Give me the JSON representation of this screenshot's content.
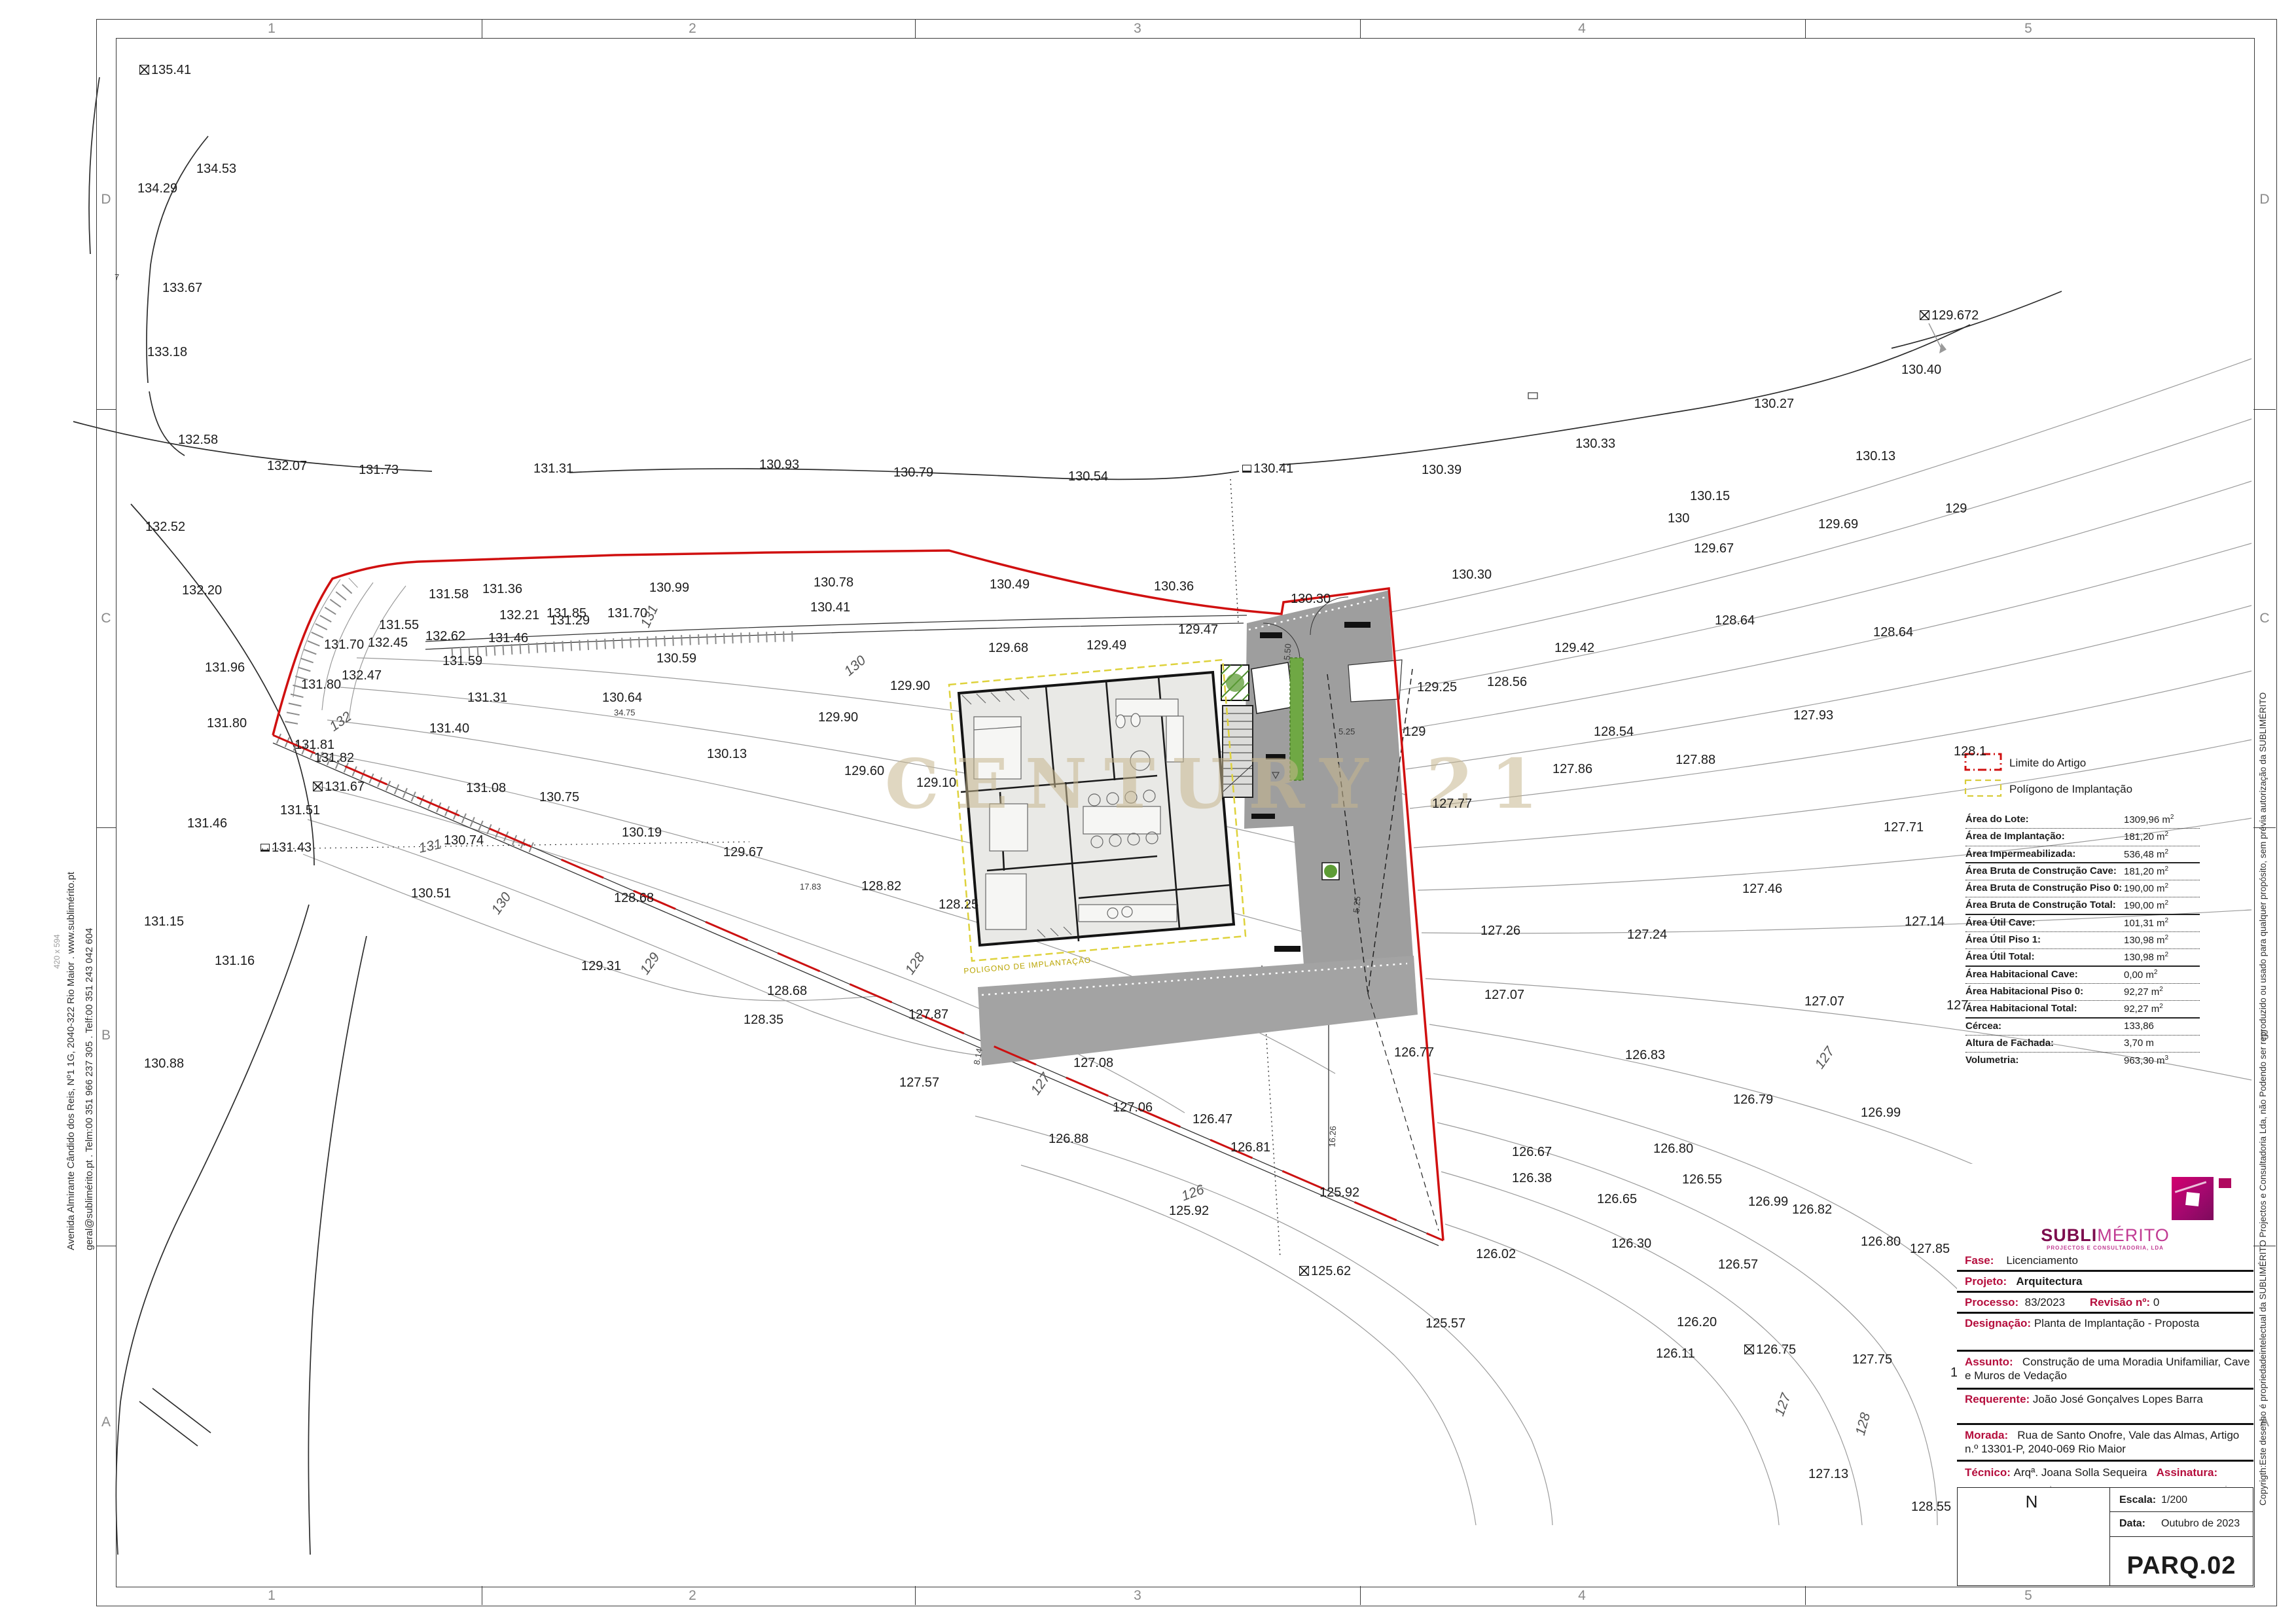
{
  "sheet": {
    "code": "PARQ.02",
    "escala_label": "Escala:",
    "escala": "1/200",
    "data_label": "Data:",
    "data": "Outubro de 2023",
    "north_label": "N",
    "paper_size": "420 x 594"
  },
  "margins": {
    "numbers": [
      "1",
      "2",
      "3",
      "4",
      "5"
    ],
    "letters": [
      "D",
      "C",
      "B",
      "A"
    ]
  },
  "side_texts": {
    "address_line1": "Avenida Almirante Cândido dos Reis, Nº1 1G, 2040-322 Rio Maior . www.sublimérito.pt",
    "address_line2": "geral@sublimérito.pt . Telm:00 351 966 237 305 . Telf:00 351 243 042 604",
    "copyright": "Copyrigth:Este desenho é propriedadeintelectual da SUBLIMÉRITO Projectos e Consultadoria Lda, não Podendo ser reproduzido ou usado para qualquer propósito, sem prévia autorização da SUBLIMÉRITO"
  },
  "watermark": "CENTURY 21",
  "legend": {
    "limite_label": "Limite do Artigo",
    "poligono_label": "Polígono de Implantação"
  },
  "logo": {
    "name_bold": "SUBLI",
    "name_light": "MÉRITO",
    "tagline": "PROJECTOS E CONSULTADORIA, LDA"
  },
  "areas_table": {
    "rows": [
      {
        "l": "Área do Lote:",
        "v": "1309,96 m",
        "s": "2",
        "sep": "dot"
      },
      {
        "l": "Área de Implantação:",
        "v": "181,20 m",
        "s": "2",
        "sep": "dot"
      },
      {
        "l": "Área Impermeabilizada:",
        "v": "536,48 m",
        "s": "2",
        "sep": "solid"
      },
      {
        "l": "Área Bruta de Construção Cave:",
        "v": "181,20 m",
        "s": "2",
        "sep": "dot"
      },
      {
        "l": "Área Bruta de Construção Piso 0:",
        "v": "190,00 m",
        "s": "2",
        "sep": "dot"
      },
      {
        "l": "Área Bruta de Construção Total:",
        "v": "190,00 m",
        "s": "2",
        "sep": "solid"
      },
      {
        "l": "Área Útil Cave:",
        "v": "101,31 m",
        "s": "2",
        "sep": "dot"
      },
      {
        "l": "Área Útil Piso 1:",
        "v": "130,98 m",
        "s": "2",
        "sep": "dot"
      },
      {
        "l": "Área Útil Total:",
        "v": "130,98 m",
        "s": "2",
        "sep": "solid"
      },
      {
        "l": "Área Habitacional Cave:",
        "v": "0,00 m",
        "s": "2",
        "sep": "dot"
      },
      {
        "l": "Área Habitacional Piso 0:",
        "v": "92,27 m",
        "s": "2",
        "sep": "dot"
      },
      {
        "l": "Área Habitacional Total: ",
        "v": "92,27 m",
        "s": "2",
        "sep": "solid"
      },
      {
        "l": "Cércea:",
        "v": "133,86",
        "s": "",
        "sep": "dot"
      },
      {
        "l": "Altura de Fachada:",
        "v": "3,70 m",
        "s": "",
        "sep": "dot"
      },
      {
        "l": "Volumetria:",
        "v": "963,30 m",
        "s": "3",
        "sep": "none"
      }
    ]
  },
  "title_block": {
    "fase_label": "Fase:",
    "fase": "Licenciamento",
    "projeto_label": "Projeto:",
    "projeto": "Arquitectura",
    "processo_label": "Processo:",
    "processo": "83/2023",
    "revisao_label": "Revisão nº:",
    "revisao": "0",
    "designacao_label": "Designação:",
    "designacao": "Planta de Implantação - Proposta",
    "assunto_label": "Assunto:",
    "assunto": "Construção de uma Moradia Unifamiliar, Cave e Muros de Vedação",
    "requerente_label": "Requerente:",
    "requerente": "João José Gonçalves Lopes Barra",
    "morada_label": "Morada:",
    "morada": "Rua de Santo Onofre, Vale das Almas, Artigo n.º 13301-P, 2040-069 Rio Maior",
    "tecnico_label": "Técnico:",
    "tecnico": "Arqª. Joana Solla Sequeira",
    "assinatura_label": "Assinatura:"
  },
  "plan": {
    "polygon_label": "POLIGONO DE IMPLANTAÇÃO",
    "labels": [
      [
        "135.41",
        213,
        107,
        "",
        0,
        "sq"
      ],
      [
        "134.53",
        300,
        258
      ],
      [
        "134.29",
        210,
        288
      ],
      [
        "133.67",
        248,
        440
      ],
      [
        "7",
        175,
        427,
        "dim"
      ],
      [
        "133.18",
        225,
        538
      ],
      [
        "132.58",
        272,
        672
      ],
      [
        "132.07",
        408,
        712
      ],
      [
        "131.73",
        548,
        718
      ],
      [
        "131.31",
        815,
        716
      ],
      [
        "130.93",
        1160,
        710
      ],
      [
        "130.79",
        1365,
        722
      ],
      [
        "130.54",
        1632,
        728
      ],
      [
        "130.41",
        1898,
        716,
        "",
        0,
        "flag"
      ],
      [
        "130.39",
        2172,
        718
      ],
      [
        "130.33",
        2407,
        678
      ],
      [
        "130.27",
        2680,
        617
      ],
      [
        "130.40",
        2905,
        565
      ],
      [
        "129.672",
        2933,
        482,
        "",
        0,
        "sq"
      ],
      [
        "130.13",
        2835,
        697
      ],
      [
        "129",
        2972,
        777
      ],
      [
        "130.30",
        2218,
        878
      ],
      [
        "130.30",
        1972,
        915
      ],
      [
        "129.69",
        2778,
        801
      ],
      [
        "129.67",
        2588,
        838
      ],
      [
        "130.15",
        2582,
        758
      ],
      [
        "130",
        2548,
        792
      ],
      [
        "129.42",
        2375,
        990
      ],
      [
        "129",
        2145,
        1118
      ],
      [
        "129.25",
        2165,
        1050
      ],
      [
        "128.64",
        2620,
        948
      ],
      [
        "128.64",
        2862,
        966
      ],
      [
        "128.54",
        2435,
        1118
      ],
      [
        "128.56",
        2272,
        1042
      ],
      [
        "129.68",
        1510,
        990
      ],
      [
        "129.49",
        1660,
        986
      ],
      [
        "129.47",
        1800,
        962
      ],
      [
        "131.55",
        579,
        955
      ],
      [
        "131.58",
        655,
        908
      ],
      [
        "131.36",
        737,
        900
      ],
      [
        "132.21",
        763,
        940
      ],
      [
        "131.85",
        835,
        937
      ],
      [
        "131.70",
        928,
        937
      ],
      [
        "131",
        985,
        957,
        "rot",
        -65
      ],
      [
        "132.62",
        650,
        972
      ],
      [
        "130.99",
        992,
        898
      ],
      [
        "130.78",
        1243,
        890
      ],
      [
        "130.49",
        1512,
        893
      ],
      [
        "130.36",
        1763,
        896
      ],
      [
        "130.41",
        1238,
        928
      ],
      [
        "131.29",
        840,
        948
      ],
      [
        "131.46",
        746,
        975
      ],
      [
        "131.59",
        676,
        1010
      ],
      [
        "131.31",
        714,
        1066
      ],
      [
        "131.40",
        656,
        1113
      ],
      [
        "131.70",
        495,
        985
      ],
      [
        "132.45",
        562,
        982
      ],
      [
        "132.47",
        522,
        1032
      ],
      [
        "131.80",
        460,
        1046
      ],
      [
        "131.96",
        313,
        1020
      ],
      [
        "132.20",
        278,
        902
      ],
      [
        "132.52",
        222,
        805
      ],
      [
        "131.80",
        316,
        1105
      ],
      [
        "132",
        506,
        1112,
        "rot",
        -35
      ],
      [
        "131.81",
        450,
        1138
      ],
      [
        "131.82",
        480,
        1158
      ],
      [
        "131.67",
        478,
        1202,
        "",
        0,
        "sq"
      ],
      [
        "131.51",
        428,
        1238
      ],
      [
        "131.43",
        398,
        1295,
        "",
        0,
        "flag"
      ],
      [
        "131.46",
        286,
        1258
      ],
      [
        "131.15",
        220,
        1408
      ],
      [
        "131.16",
        328,
        1468
      ],
      [
        "130.88",
        220,
        1625
      ],
      [
        "131",
        640,
        1296,
        "rot",
        -12
      ],
      [
        "130.59",
        1003,
        1006
      ],
      [
        "130.64",
        920,
        1066
      ],
      [
        "34.75",
        938,
        1092,
        "dim"
      ],
      [
        "130",
        1293,
        1028,
        "rot",
        -40
      ],
      [
        "129.90",
        1360,
        1048
      ],
      [
        "129.90",
        1250,
        1096
      ],
      [
        "129.60",
        1290,
        1178
      ],
      [
        "129.10",
        1400,
        1196
      ],
      [
        "130.13",
        1080,
        1152
      ],
      [
        "130.75",
        824,
        1218
      ],
      [
        "131.08",
        712,
        1204
      ],
      [
        "130.19",
        950,
        1272
      ],
      [
        "129.67",
        1105,
        1302
      ],
      [
        "130.74",
        678,
        1284
      ],
      [
        "130.51",
        628,
        1365
      ],
      [
        "130",
        756,
        1394,
        "rot",
        -55
      ],
      [
        "128.82",
        1316,
        1354
      ],
      [
        "17.83",
        1222,
        1358,
        "dim"
      ],
      [
        "128.25",
        1434,
        1382
      ],
      [
        "128.68",
        938,
        1372
      ],
      [
        "128.68",
        1172,
        1514
      ],
      [
        "128.35",
        1136,
        1558
      ],
      [
        "129.31",
        888,
        1476
      ],
      [
        "129",
        983,
        1486,
        "rot",
        -55
      ],
      [
        "128",
        1388,
        1486,
        "rot",
        -55
      ],
      [
        "127.87",
        1388,
        1550
      ],
      [
        "127.57",
        1374,
        1654
      ],
      [
        "127.06",
        1700,
        1692
      ],
      [
        "127.08",
        1640,
        1624
      ],
      [
        "127",
        1580,
        1670,
        "rot",
        -55
      ],
      [
        "126.88",
        1602,
        1740
      ],
      [
        "126.47",
        1822,
        1710
      ],
      [
        "125.92",
        1786,
        1850
      ],
      [
        "126",
        1806,
        1828,
        "rot",
        -20
      ],
      [
        "125.92",
        2016,
        1822
      ],
      [
        "125.62",
        1985,
        1942,
        "",
        0,
        "sq"
      ],
      [
        "126.02",
        2255,
        1916
      ],
      [
        "125.57",
        2178,
        2022
      ],
      [
        "126.81",
        1880,
        1753
      ],
      [
        "126.77",
        2130,
        1608
      ],
      [
        "127.77",
        2188,
        1228
      ],
      [
        "127.93",
        2740,
        1093
      ],
      [
        "128.1",
        2985,
        1148
      ],
      [
        "127.88",
        2560,
        1161
      ],
      [
        "127.86",
        2372,
        1175
      ],
      [
        "127.71",
        2878,
        1264
      ],
      [
        "127.46",
        2662,
        1358
      ],
      [
        "127.24",
        2486,
        1428
      ],
      [
        "127.14",
        2910,
        1408
      ],
      [
        "127.26",
        2262,
        1422
      ],
      [
        "127.07",
        2757,
        1530
      ],
      [
        "127.07",
        2268,
        1520
      ],
      [
        "127",
        2974,
        1536
      ],
      [
        "127",
        2778,
        1630,
        "rot",
        -55
      ],
      [
        "126.83",
        2483,
        1612
      ],
      [
        "126.79",
        2648,
        1680
      ],
      [
        "126.99",
        2843,
        1700
      ],
      [
        "126.80",
        2526,
        1755
      ],
      [
        "126.67",
        2310,
        1760
      ],
      [
        "126.65",
        2440,
        1832
      ],
      [
        "126.99",
        2671,
        1836
      ],
      [
        "126.80",
        2843,
        1897
      ],
      [
        "126.55",
        2570,
        1802
      ],
      [
        "126.38",
        2310,
        1800
      ],
      [
        "126.82",
        2738,
        1848
      ],
      [
        "126.30",
        2462,
        1900
      ],
      [
        "126.57",
        2625,
        1932
      ],
      [
        "127.85",
        2918,
        1908
      ],
      [
        "126.20",
        2562,
        2020
      ],
      [
        "126.75",
        2665,
        2062,
        "",
        0,
        "sq"
      ],
      [
        "127.75",
        2830,
        2077
      ],
      [
        "128",
        2980,
        2097
      ],
      [
        "126.11",
        2530,
        2068
      ],
      [
        "127.13",
        2763,
        2252
      ],
      [
        "128.55",
        2920,
        2302
      ],
      [
        "127",
        2718,
        2162,
        "rot",
        -70
      ],
      [
        "128",
        2842,
        2192,
        "rot",
        -75
      ],
      [
        "5.50",
        1966,
        1012,
        "dim",
        -85
      ],
      [
        "5.25",
        2045,
        1121,
        "dim"
      ],
      [
        "5.25",
        2072,
        1398,
        "dim",
        -85
      ],
      [
        "8.14",
        1492,
        1630,
        "dim",
        -80
      ],
      [
        "16.26",
        2035,
        1756,
        "dim",
        -87
      ]
    ]
  }
}
